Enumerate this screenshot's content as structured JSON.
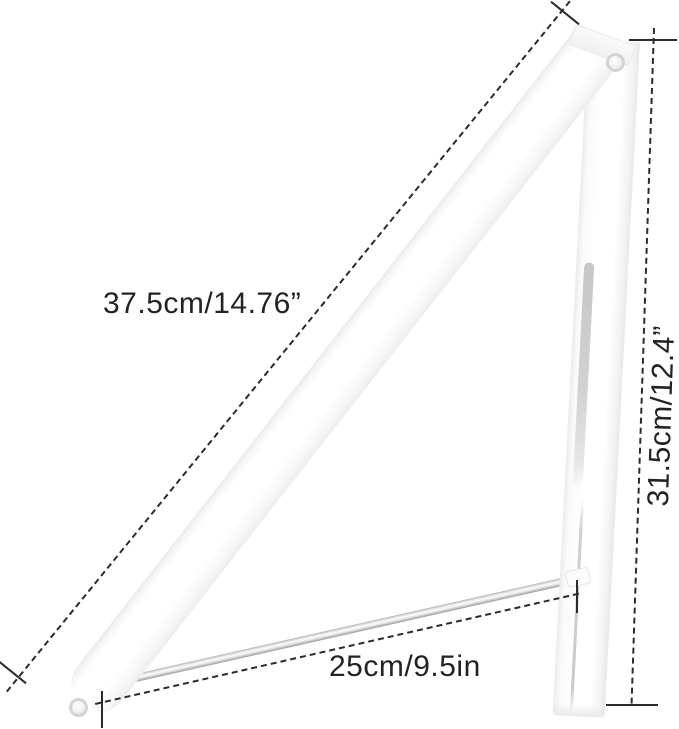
{
  "dimensions": {
    "arm": {
      "label": "37.5cm/14.76”"
    },
    "height": {
      "label": "31.5cm/12.4”"
    },
    "rod": {
      "label": "25cm/9.5in"
    }
  },
  "colors": {
    "background": "#ffffff",
    "dimension_lines": "#2b2b2b",
    "label_text": "#232323",
    "product_body": "#ffffff",
    "product_shadow": "#ececee",
    "metal_rod": "#c7c9cb"
  }
}
